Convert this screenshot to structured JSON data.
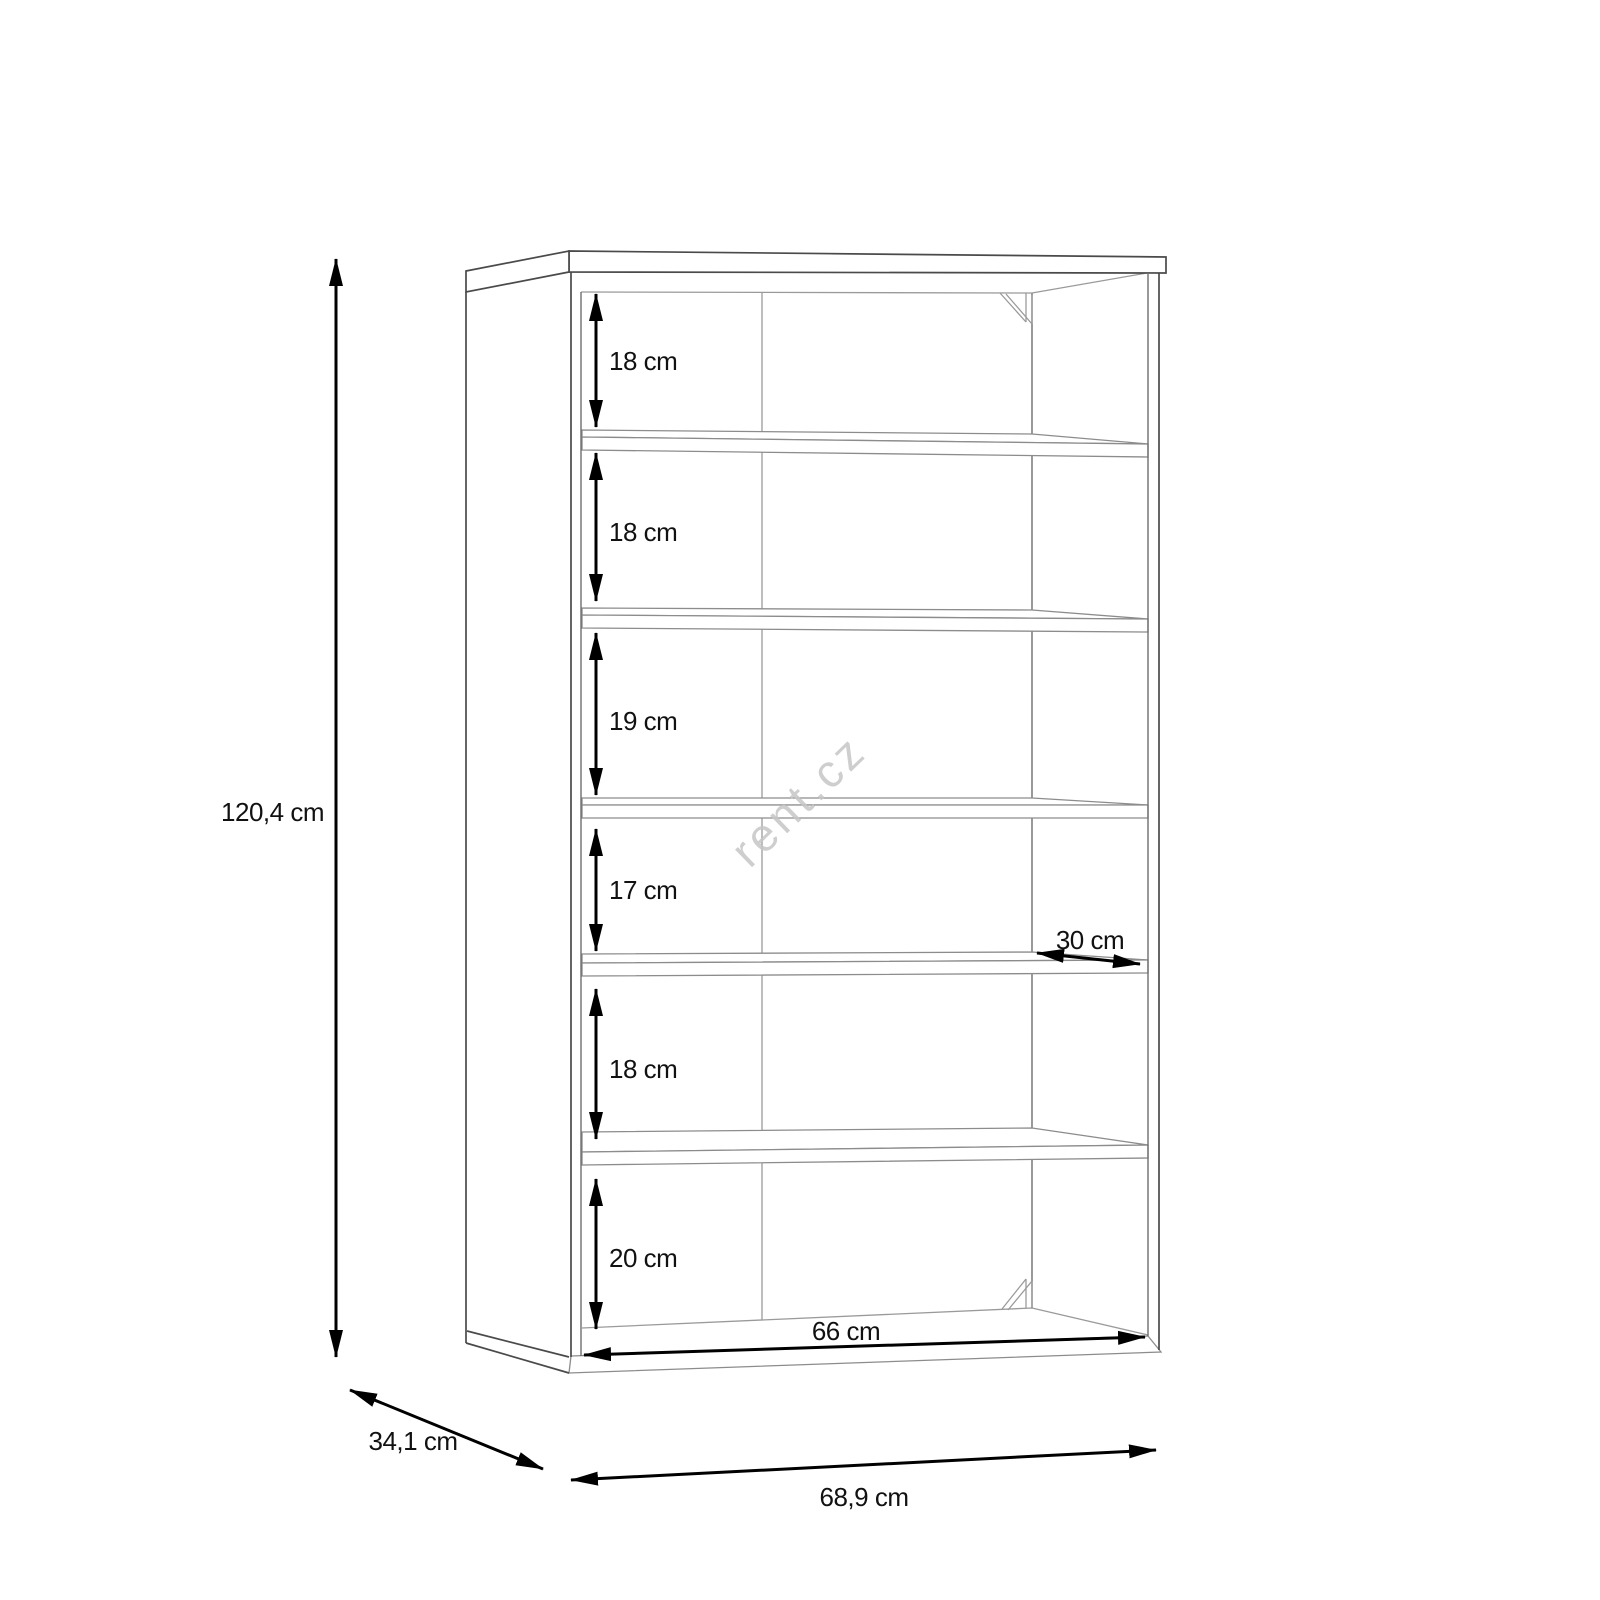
{
  "page": {
    "background": "#ffffff"
  },
  "colors": {
    "carcass_outline": "#4a4a4a",
    "shelf_outline": "#8c8c8c",
    "dimension_lines": "#000000",
    "label_text": "#111111",
    "watermark": "#c6c6c6"
  },
  "watermark": {
    "text": "rent.cz"
  },
  "drawing": {
    "subject": "open shelving unit line drawing",
    "shelf_count": 5,
    "compartment_count": 6
  },
  "dimensions": {
    "overall_height": {
      "label": "120,4 cm",
      "value_cm": 120.4,
      "orientation": "vertical"
    },
    "overall_width": {
      "label": "68,9 cm",
      "value_cm": 68.9,
      "orientation": "horizontal"
    },
    "overall_depth": {
      "label": "34,1 cm",
      "value_cm": 34.1,
      "orientation": "diagonal"
    },
    "inner_width": {
      "label": "66 cm",
      "value_cm": 66,
      "orientation": "horizontal"
    },
    "shelf_depth": {
      "label": "30 cm",
      "value_cm": 30,
      "orientation": "diagonal"
    },
    "compartment_heights": [
      {
        "label": "18 cm",
        "value_cm": 18
      },
      {
        "label": "18 cm",
        "value_cm": 18
      },
      {
        "label": "19 cm",
        "value_cm": 19
      },
      {
        "label": "17 cm",
        "value_cm": 17
      },
      {
        "label": "18 cm",
        "value_cm": 18
      },
      {
        "label": "20 cm",
        "value_cm": 20
      }
    ]
  }
}
